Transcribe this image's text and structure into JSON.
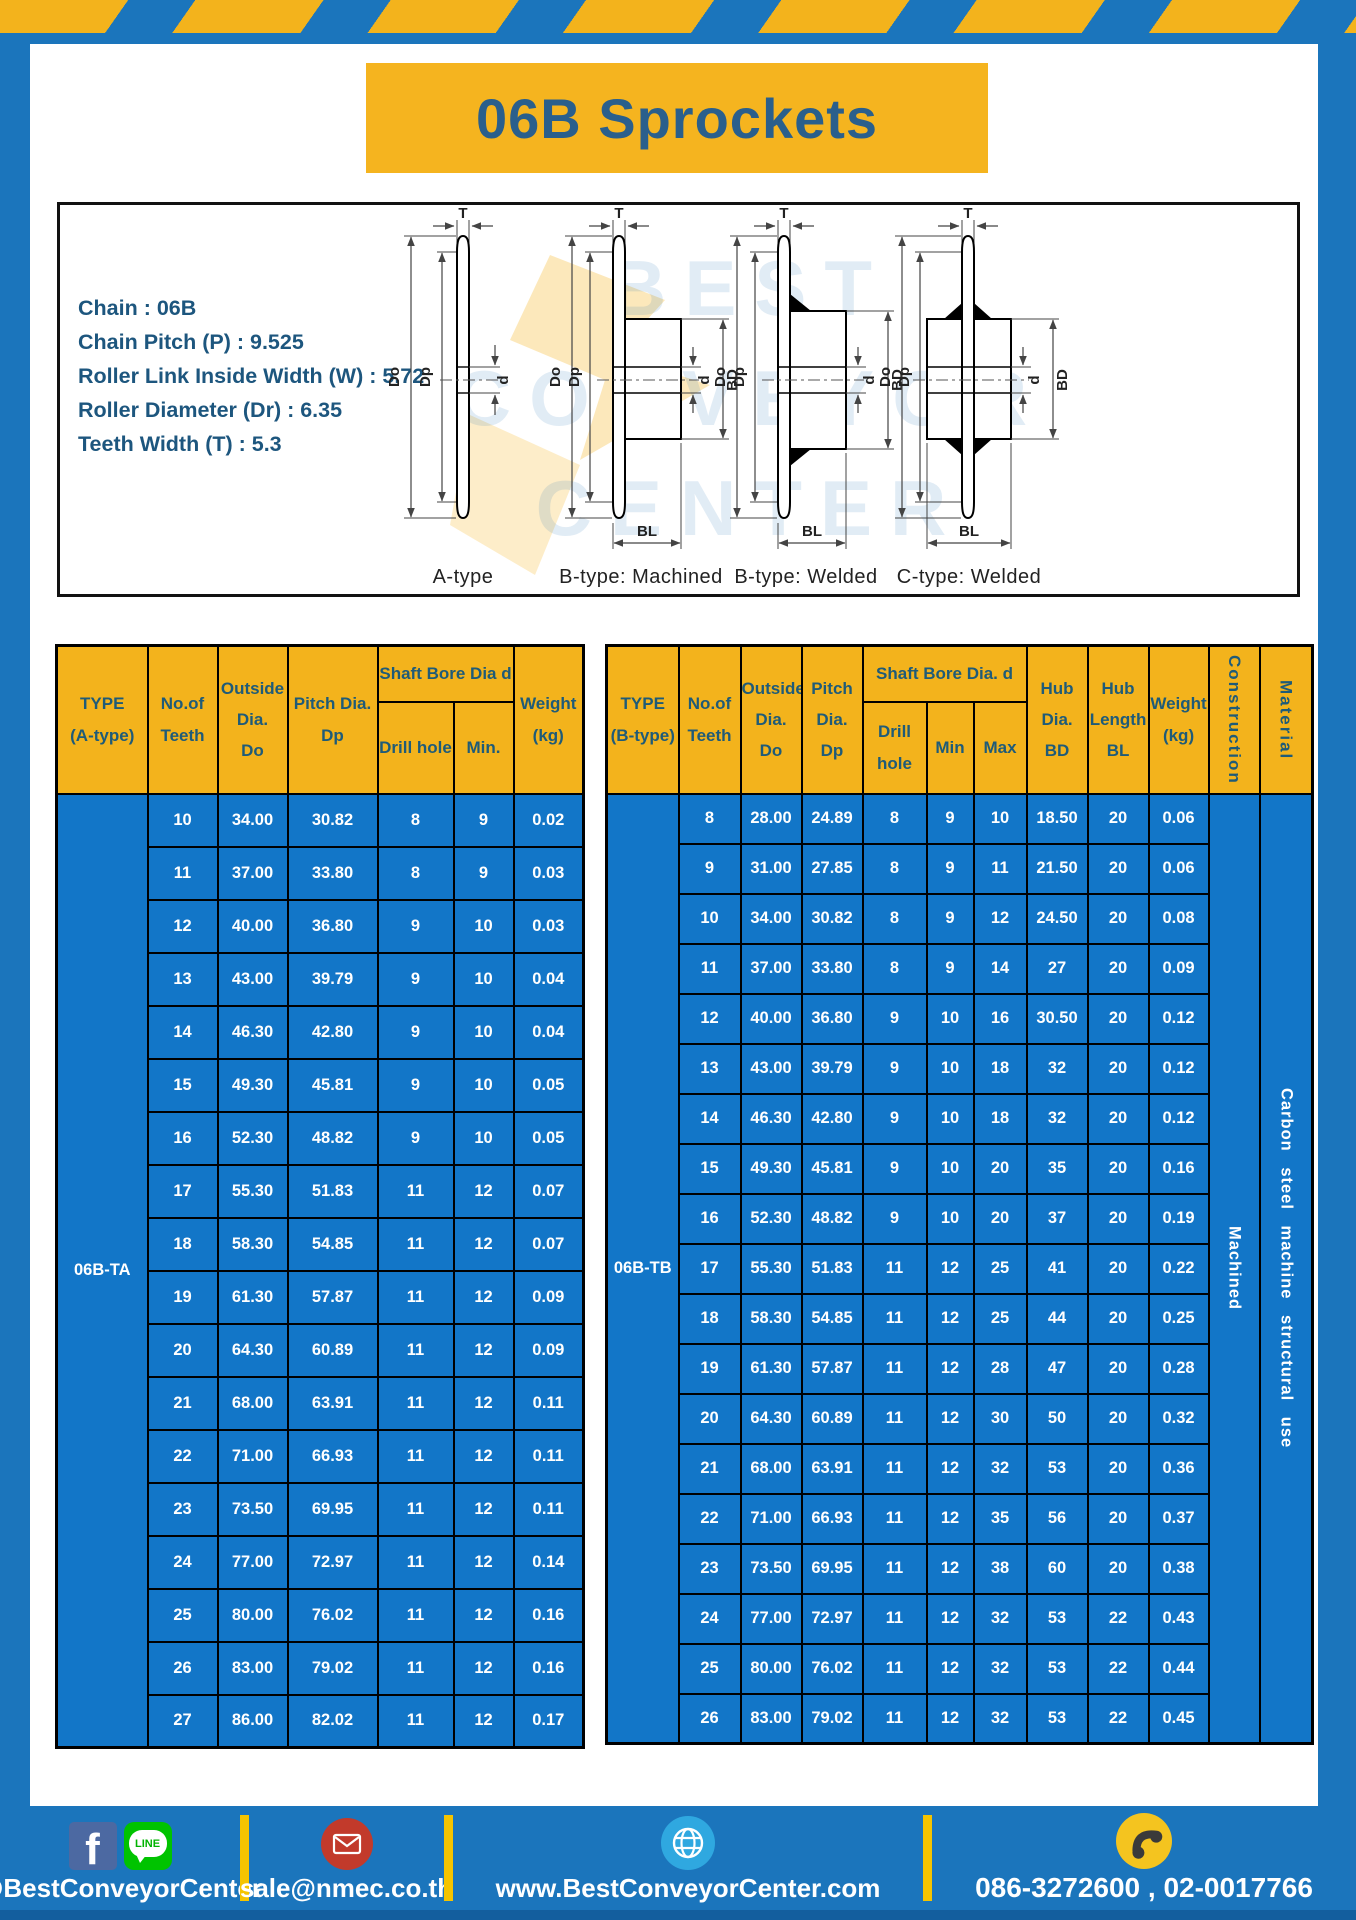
{
  "page": {
    "title": "06B Sprockets"
  },
  "specs": {
    "lines": [
      "Chain  : 06B",
      "Chain Pitch (P)  :  9.525",
      "Roller Link Inside Width (W)  :  5.72",
      "Roller Diameter (Dr)  : 6.35",
      "Teeth Width (T)  :  5.3"
    ]
  },
  "watermark": {
    "text": "BEST CONVEYOR CENTER"
  },
  "diagrams": {
    "dims": {
      "t": "T",
      "do": "Do",
      "dp": "Dp",
      "d": "d",
      "bd": "BD",
      "bl": "BL"
    },
    "captions": [
      "A-type",
      "B-type: Machined",
      "B-type: Welded",
      "C-type: Welded"
    ]
  },
  "table_a": {
    "headers": {
      "type": "TYPE\n(A-type)",
      "teeth": "No.of\nTeeth",
      "outside": "Outside\nDia.\nDo",
      "pitch": "Pitch Dia.\nDp",
      "shaft_group": "Shaft Bore Dia d",
      "drill": "Drill hole",
      "min": "Min.",
      "weight": "Weight\n(kg)"
    },
    "type_label": "06B-TA",
    "rows": [
      [
        "10",
        "34.00",
        "30.82",
        "8",
        "9",
        "0.02"
      ],
      [
        "11",
        "37.00",
        "33.80",
        "8",
        "9",
        "0.03"
      ],
      [
        "12",
        "40.00",
        "36.80",
        "9",
        "10",
        "0.03"
      ],
      [
        "13",
        "43.00",
        "39.79",
        "9",
        "10",
        "0.04"
      ],
      [
        "14",
        "46.30",
        "42.80",
        "9",
        "10",
        "0.04"
      ],
      [
        "15",
        "49.30",
        "45.81",
        "9",
        "10",
        "0.05"
      ],
      [
        "16",
        "52.30",
        "48.82",
        "9",
        "10",
        "0.05"
      ],
      [
        "17",
        "55.30",
        "51.83",
        "11",
        "12",
        "0.07"
      ],
      [
        "18",
        "58.30",
        "54.85",
        "11",
        "12",
        "0.07"
      ],
      [
        "19",
        "61.30",
        "57.87",
        "11",
        "12",
        "0.09"
      ],
      [
        "20",
        "64.30",
        "60.89",
        "11",
        "12",
        "0.09"
      ],
      [
        "21",
        "68.00",
        "63.91",
        "11",
        "12",
        "0.11"
      ],
      [
        "22",
        "71.00",
        "66.93",
        "11",
        "12",
        "0.11"
      ],
      [
        "23",
        "73.50",
        "69.95",
        "11",
        "12",
        "0.11"
      ],
      [
        "24",
        "77.00",
        "72.97",
        "11",
        "12",
        "0.14"
      ],
      [
        "25",
        "80.00",
        "76.02",
        "11",
        "12",
        "0.16"
      ],
      [
        "26",
        "83.00",
        "79.02",
        "11",
        "12",
        "0.16"
      ],
      [
        "27",
        "86.00",
        "82.02",
        "11",
        "12",
        "0.17"
      ]
    ]
  },
  "table_b": {
    "headers": {
      "type": "TYPE\n(B-type)",
      "teeth": "No.of\nTeeth",
      "outside": "Outside\nDia.\nDo",
      "pitch": "Pitch\nDia.\nDp",
      "shaft_group": "Shaft Bore Dia.  d",
      "drill": "Drill hole",
      "min": "Min",
      "max": "Max",
      "hub_dia": "Hub\nDia.\nBD",
      "hub_len": "Hub\nLength\nBL",
      "weight": "Weight\n(kg)",
      "construction": "Construction",
      "material": "Material"
    },
    "type_label": "06B-TB",
    "construction_value": "Machined",
    "material_value": "Carbon steel machine structural use",
    "rows": [
      [
        "8",
        "28.00",
        "24.89",
        "8",
        "9",
        "10",
        "18.50",
        "20",
        "0.06"
      ],
      [
        "9",
        "31.00",
        "27.85",
        "8",
        "9",
        "11",
        "21.50",
        "20",
        "0.06"
      ],
      [
        "10",
        "34.00",
        "30.82",
        "8",
        "9",
        "12",
        "24.50",
        "20",
        "0.08"
      ],
      [
        "11",
        "37.00",
        "33.80",
        "8",
        "9",
        "14",
        "27",
        "20",
        "0.09"
      ],
      [
        "12",
        "40.00",
        "36.80",
        "9",
        "10",
        "16",
        "30.50",
        "20",
        "0.12"
      ],
      [
        "13",
        "43.00",
        "39.79",
        "9",
        "10",
        "18",
        "32",
        "20",
        "0.12"
      ],
      [
        "14",
        "46.30",
        "42.80",
        "9",
        "10",
        "18",
        "32",
        "20",
        "0.12"
      ],
      [
        "15",
        "49.30",
        "45.81",
        "9",
        "10",
        "20",
        "35",
        "20",
        "0.16"
      ],
      [
        "16",
        "52.30",
        "48.82",
        "9",
        "10",
        "20",
        "37",
        "20",
        "0.19"
      ],
      [
        "17",
        "55.30",
        "51.83",
        "11",
        "12",
        "25",
        "41",
        "20",
        "0.22"
      ],
      [
        "18",
        "58.30",
        "54.85",
        "11",
        "12",
        "25",
        "44",
        "20",
        "0.25"
      ],
      [
        "19",
        "61.30",
        "57.87",
        "11",
        "12",
        "28",
        "47",
        "20",
        "0.28"
      ],
      [
        "20",
        "64.30",
        "60.89",
        "11",
        "12",
        "30",
        "50",
        "20",
        "0.32"
      ],
      [
        "21",
        "68.00",
        "63.91",
        "11",
        "12",
        "32",
        "53",
        "20",
        "0.36"
      ],
      [
        "22",
        "71.00",
        "66.93",
        "11",
        "12",
        "35",
        "56",
        "20",
        "0.37"
      ],
      [
        "23",
        "73.50",
        "69.95",
        "11",
        "12",
        "38",
        "60",
        "20",
        "0.38"
      ],
      [
        "24",
        "77.00",
        "72.97",
        "11",
        "12",
        "32",
        "53",
        "22",
        "0.43"
      ],
      [
        "25",
        "80.00",
        "76.02",
        "11",
        "12",
        "32",
        "53",
        "22",
        "0.44"
      ],
      [
        "26",
        "83.00",
        "79.02",
        "11",
        "12",
        "32",
        "53",
        "22",
        "0.45"
      ]
    ]
  },
  "footer": {
    "social": "@BestConveyorCenter",
    "email": "sale@nmec.co.th",
    "website": "www.BestConveyorCenter.com",
    "phone": "086-3272600 , 02-0017766",
    "facebook_letter": "f",
    "line_label": "LINE"
  },
  "colors": {
    "frame_blue": "#1b75bc",
    "accent_yellow": "#f3b31c",
    "cell_blue": "#1276c8",
    "header_text": "#1f5b78",
    "title_text": "#2a5f8c",
    "footer_strip": "#135e9e"
  }
}
